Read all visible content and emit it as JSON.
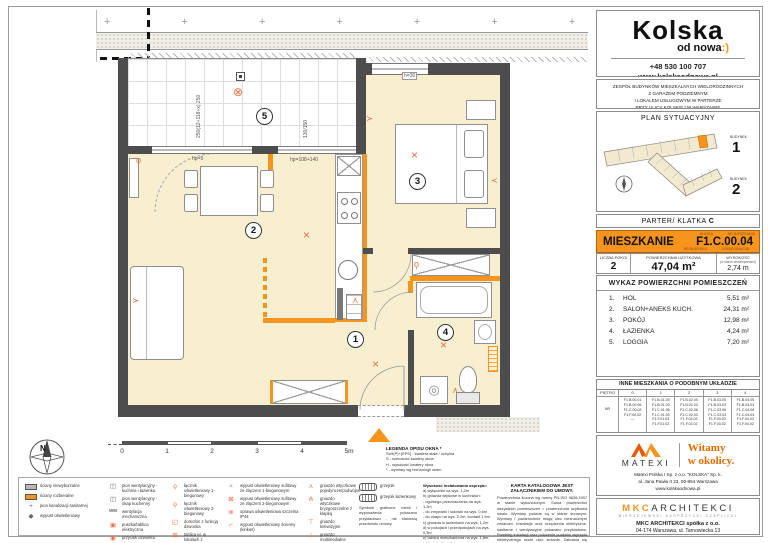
{
  "colors": {
    "accent": "#f7941e",
    "symbol": "#ed7045",
    "wall": "#4d4d4d",
    "floor": "#f7efcf"
  },
  "plan": {
    "terrain_pattern": "+ + + + + + + + + + + +",
    "rooms": [
      {
        "num": "1"
      },
      {
        "num": "2"
      },
      {
        "num": "3"
      },
      {
        "num": "4"
      },
      {
        "num": "5"
      }
    ],
    "dims": {
      "d1": "250(12+118+x) 250",
      "d2": "130/150",
      "d3": "hp=5",
      "d4": "hp=108+140",
      "d5": "h=30"
    },
    "symbols": {
      "cross": "×",
      "sealed": "⊗",
      "switch": "ϙ",
      "socket": "⋏",
      "washer": "◎",
      "sinkglyph": "⌀"
    },
    "compass_north": "N"
  },
  "scalebar": {
    "ticks": [
      "0",
      "1",
      "2",
      "3",
      "4",
      "5m"
    ]
  },
  "window_legend": {
    "title": "LEGENDA OPISU OKNA *",
    "lines": [
      "SxH(P)+(EPS) - kwatera stała / uchylna",
      "S - szerokość kwatery okna",
      "H - wysokość kwatery okna",
      "* - wymiary wg technologii okien"
    ]
  },
  "legend": {
    "colA": [
      {
        "glyph": "",
        "label": "ściany niewyburzalne"
      },
      {
        "glyph": "",
        "label": "ściany rozbieralne"
      },
      {
        "glyph": "+",
        "label": "pion kanalizacji sanitarnej"
      },
      {
        "glyph": "◆",
        "label": "wypust oświetleniowy"
      }
    ],
    "colB": [
      {
        "glyph": "◫",
        "label": "pion wentylacyjny - kuchnia i łazienka"
      },
      {
        "glyph": "◫",
        "label": "pion wentylacyjny - okap kuchenny"
      },
      {
        "glyph": "WM",
        "label": "wentylacja mechaniczna"
      },
      {
        "glyph": "▣",
        "label": "puszka/tablica elektryczna"
      },
      {
        "glyph": "◉",
        "label": "przycisk dzwonka"
      }
    ],
    "colC": [
      {
        "glyph": "ϙ",
        "label": "łącznik oświetleniowy 1-biegunowy"
      },
      {
        "glyph": "ϙ",
        "label": "łącznik oświetleniowy 2-biegunowy"
      },
      {
        "glyph": "◱",
        "label": "domofon z funkcją dzwonka"
      },
      {
        "glyph": "⊞",
        "label": "tablica el. w lokalach z gniazdem"
      }
    ],
    "colD": [
      {
        "glyph": "×",
        "label": "wypust oświetleniowy sufitowy ze złączem 1-biegunowym"
      },
      {
        "glyph": "⊠",
        "label": "wypust oświetleniowy sufitowy ze złączem 2-biegunowym"
      },
      {
        "glyph": "⊗",
        "label": "oprawa oświetleniowa szczelna IP44"
      },
      {
        "glyph": "⌐",
        "label": "wypust oświetleniowy ścienny (kinkiet)"
      }
    ],
    "colE": [
      {
        "glyph": "⋏",
        "label": "gniazdo wtyczkowe pojedyncze/podwójne"
      },
      {
        "glyph": "⋔",
        "label": "gniazdo wtyczkowe bryzgoszczelne z klapką"
      },
      {
        "glyph": "⊤",
        "label": "gniazdo telewizyjne"
      },
      {
        "glyph": "⊥",
        "label": "gniazdo multimedialne"
      }
    ],
    "colF": [
      {
        "glyph": "",
        "label": "grzejnik"
      },
      {
        "glyph": "",
        "label": "grzejnik łazienkowy"
      }
    ],
    "colF_note": "Symbole graficzne mebli i wyposażenia pokazano przykładowo - nie stanowią przedmiotu umowy."
  },
  "heights_note": {
    "title": "Wysokość instalowania osprzętu:",
    "lines": [
      "a) wyłączniki na wys. 1,2m",
      "b) gniazda wtykowe w kuchniach:",
      "- ogólnego przeznaczenia na wys. 1,2m",
      "- do zmywarki i lodówki na wys. 0,6m",
      "- do okapu na wys. 2,2m, kontakt 1,9m",
      "c) gniazda w łazienkach na wys. 1,2m",
      "d) w pokojach i przedpokojach na wys. 0,3m",
      "e) tablica mieszkaniowa na wys. 1,8m, tablice multimedialne z gniazdem na wys. 0,3m"
    ]
  },
  "karta": {
    "title": "KARTA KATALOGOWA JEST ZAŁĄCZNIKIEM DO UMOWY.",
    "text": "Powierzchnia liczona wg normy PN-ISO 9836:1997 w stanie wykończonym. Suma powierzchni wszystkich pomieszczeń = powierzchnia użytkowa lokalu. Wymiary podane są w stanie surowym. Wymiary i powierzchnie mogą ulec nieznacznym zmianom. Instalacje oraz urządzenia elektryczne, sanitarne i wentylacyjne pokazano przykładowo. Przebieg instalacji oraz położenie punktów osprzętu elektrycznego może ulec zmianie. Zabrania się ingerencji w elementy nośne budynku oraz szachty instalacyjne."
  },
  "sidebar": {
    "brand": {
      "name": "Kolska",
      "sub": "od nowa",
      "smile": ":)",
      "phone": "+48 530 100 707",
      "site": "www.kolskaodnowa.pl"
    },
    "description": [
      "ZESPÓŁ BUDYNKÓW MIESZKALNYCH WIELORODZINNYCH",
      "Z GARAŻEM PODZIEMNYM",
      "I LOKALEM USŁUGOWYM W PARTERZE",
      "PRZY ULICY KOLSKIEJ W WARSZAWIE"
    ],
    "site_plan": {
      "title": "PLAN SYTUACYJNY",
      "b1_label": "BUDYNEK",
      "b1_num": "1",
      "b2_label": "BUDYNEK",
      "b2_num": "2"
    },
    "floor_bar": {
      "prefix": "PARTER/ KLATKA",
      "klatka": "C"
    },
    "unit": {
      "label": "MIESZKANIE",
      "code": "F1.C.00.04",
      "tag1": "KLATKA",
      "tag2": "NR MIESZKANIA",
      "tag3": "NR BUDYNKU",
      "tag4": "KONDYGNACJA"
    },
    "stats": {
      "s1_label": "LICZBA POKOI",
      "s1_value": "2",
      "s2_label": "POWIERZCHNIA UŻYTKOWA",
      "s2_value": "47,04 m²",
      "s3_label": "WYSOKOŚĆ",
      "s3_sub": "(w stanie deweloperskim)",
      "s3_value": "2,74 m"
    },
    "rooms": {
      "title": "WYKAZ POWIERZCHNI POMIESZCZEŃ",
      "items": [
        {
          "no": "1.",
          "name": "HOL",
          "area": "5,51 m²"
        },
        {
          "no": "2.",
          "name": "SALON+ANEKS KUCH.",
          "area": "24,31 m²"
        },
        {
          "no": "3.",
          "name": "POKÓJ",
          "area": "12,98 m²"
        },
        {
          "no": "4.",
          "name": "ŁAZIENKA",
          "area": "4,24 m²"
        },
        {
          "no": "5.",
          "name": "LOGGIA",
          "area": "7,20 m²"
        }
      ]
    },
    "similar": {
      "title": "INNE MIESZKANIA O PODOBNYM UKŁADZIE",
      "floor_label": "PIĘTRO",
      "row_label": "NR",
      "floors": [
        "0",
        "1",
        "2",
        "3",
        "4"
      ],
      "codes0": [
        "F1.B.00.01",
        "F1.B.00.06",
        "F1.C.00.03",
        "F1.F.00.02",
        "—"
      ],
      "codes1": [
        "F1.B.01.05",
        "F1.B.01.03",
        "F1.C.01.06",
        "F1.C.01.03",
        "F1.F.01.03",
        "F1.F.01.02"
      ],
      "codes2": [
        "F1.B.02.05",
        "F1.B.02.03",
        "F1.C.02.06",
        "F1.C.02.03",
        "F1.F.02.03",
        "F1.F.02.02"
      ],
      "codes3": [
        "F1.B.03.05",
        "F1.B.03.03",
        "F1.C.03.06",
        "F1.C.03.03",
        "F1.F.03.03",
        "F1.F.03.02"
      ],
      "codes4": [
        "F1.B.04.05",
        "F1.B.04.03",
        "F1.C.04.06",
        "F1.C.04.03",
        "F1.F.04.03",
        "F1.F.04.02"
      ]
    },
    "matexi": {
      "name": "MATEXI",
      "tagline": [
        "Witamy",
        "w okolicy."
      ],
      "addr": [
        "Matexi Polska I Sp. z o.o. \"KOLSKA\" Sp. k.",
        "al. Jana Pawła II 23, 00-854 Warszawa",
        "www.kolskaodnowa.pl"
      ]
    },
    "mkc": {
      "name1": "MKC",
      "name2": "ARCHITEKCI",
      "subtitle": "MIERZEJEWSKI KASPRZYCKI CZAPLICKI",
      "addr1": "MKC ARCHITEKCI spółka z o.o.",
      "addr2": "04-174 Warszawa, ul. Tarnowiecka 13",
      "addr3": "tel.: (22) 612-43-44, e-mail: biuro@mkc.com.pl"
    }
  }
}
